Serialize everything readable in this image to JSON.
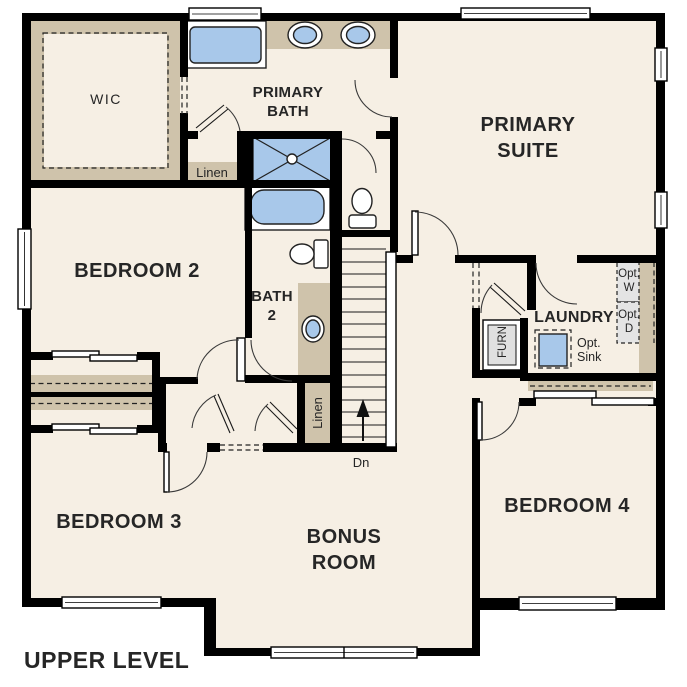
{
  "title": "UPPER LEVEL",
  "colors": {
    "floor": "#f6efe4",
    "builtin_tan": "#cfc3ab",
    "wall": "#000000",
    "fixture_blue": "#a8c8ea",
    "option_gray": "#e4e4e4"
  },
  "rooms": {
    "wic": "WIC",
    "primary_bath": {
      "line1": "PRIMARY",
      "line2": "BATH"
    },
    "primary_suite": {
      "line1": "PRIMARY",
      "line2": "SUITE"
    },
    "bedroom2": "BEDROOM 2",
    "bath2": {
      "line1": "BATH",
      "line2": "2"
    },
    "laundry": "LAUNDRY",
    "bedroom3": "BEDROOM 3",
    "bonus_room": {
      "line1": "BONUS",
      "line2": "ROOM"
    },
    "bedroom4": "BEDROOM 4"
  },
  "features": {
    "linen_upper": "Linen",
    "linen_hall": "Linen",
    "furnace": "FURN",
    "opt_washer": {
      "line1": "Opt.",
      "line2": "W"
    },
    "opt_dryer": {
      "line1": "Opt.",
      "line2": "D"
    },
    "opt_sink": {
      "line1": "Opt.",
      "line2": "Sink"
    },
    "stairs_down": "Dn"
  }
}
